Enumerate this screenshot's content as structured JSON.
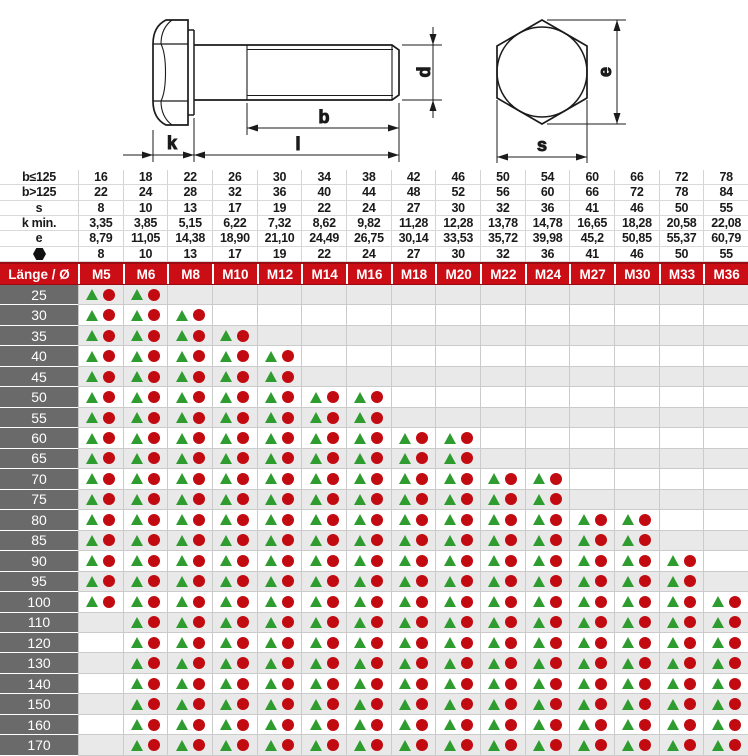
{
  "drawing": {
    "labels": {
      "k": "k",
      "b": "b",
      "l": "l",
      "d": "d",
      "e": "e",
      "s": "s"
    }
  },
  "spec_table": {
    "rows": [
      {
        "label": "b≤125",
        "values": [
          "16",
          "18",
          "22",
          "26",
          "30",
          "34",
          "38",
          "42",
          "46",
          "50",
          "54",
          "60",
          "66",
          "72",
          "78"
        ]
      },
      {
        "label": "b>125",
        "values": [
          "22",
          "24",
          "28",
          "32",
          "36",
          "40",
          "44",
          "48",
          "52",
          "56",
          "60",
          "66",
          "72",
          "78",
          "84"
        ]
      },
      {
        "label": "s",
        "values": [
          "8",
          "10",
          "13",
          "17",
          "19",
          "22",
          "24",
          "27",
          "30",
          "32",
          "36",
          "41",
          "46",
          "50",
          "55"
        ]
      },
      {
        "label": "k min.",
        "values": [
          "3,35",
          "3,85",
          "5,15",
          "6,22",
          "7,32",
          "8,62",
          "9,82",
          "11,28",
          "12,28",
          "13,78",
          "14,78",
          "16,65",
          "18,28",
          "20,58",
          "22,08"
        ]
      },
      {
        "label": "e",
        "values": [
          "8,79",
          "11,05",
          "14,38",
          "18,90",
          "21,10",
          "24,49",
          "26,75",
          "30,14",
          "33,53",
          "35,72",
          "39,98",
          "45,2",
          "50,85",
          "55,37",
          "60,79"
        ]
      },
      {
        "label": "",
        "icon": "hexagon-icon",
        "values": [
          "8",
          "10",
          "13",
          "17",
          "19",
          "22",
          "24",
          "27",
          "30",
          "32",
          "36",
          "41",
          "46",
          "50",
          "55"
        ]
      }
    ]
  },
  "matrix": {
    "corner_label": "Länge / Ø",
    "columns": [
      "M5",
      "M6",
      "M8",
      "M10",
      "M12",
      "M14",
      "M16",
      "M18",
      "M20",
      "M22",
      "M24",
      "M27",
      "M30",
      "M33",
      "M36"
    ],
    "cell_symbols": [
      "triangle",
      "circle"
    ],
    "rows": [
      {
        "length": "25",
        "from": "M5",
        "to": "M6"
      },
      {
        "length": "30",
        "from": "M5",
        "to": "M8"
      },
      {
        "length": "35",
        "from": "M5",
        "to": "M10"
      },
      {
        "length": "40",
        "from": "M5",
        "to": "M12"
      },
      {
        "length": "45",
        "from": "M5",
        "to": "M12"
      },
      {
        "length": "50",
        "from": "M5",
        "to": "M16"
      },
      {
        "length": "55",
        "from": "M5",
        "to": "M16"
      },
      {
        "length": "60",
        "from": "M5",
        "to": "M20"
      },
      {
        "length": "65",
        "from": "M5",
        "to": "M20"
      },
      {
        "length": "70",
        "from": "M5",
        "to": "M24"
      },
      {
        "length": "75",
        "from": "M5",
        "to": "M24"
      },
      {
        "length": "80",
        "from": "M5",
        "to": "M30"
      },
      {
        "length": "85",
        "from": "M5",
        "to": "M30"
      },
      {
        "length": "90",
        "from": "M5",
        "to": "M33"
      },
      {
        "length": "95",
        "from": "M5",
        "to": "M33"
      },
      {
        "length": "100",
        "from": "M5",
        "to": "M36"
      },
      {
        "length": "110",
        "from": "M6",
        "to": "M36"
      },
      {
        "length": "120",
        "from": "M6",
        "to": "M36"
      },
      {
        "length": "130",
        "from": "M6",
        "to": "M36"
      },
      {
        "length": "140",
        "from": "M6",
        "to": "M36"
      },
      {
        "length": "150",
        "from": "M6",
        "to": "M36"
      },
      {
        "length": "160",
        "from": "M6",
        "to": "M36"
      },
      {
        "length": "170",
        "from": "M6",
        "to": "M36"
      }
    ]
  },
  "colors": {
    "header_red": "#cb0e16",
    "label_gray": "#6a6a6a",
    "row_alt_gray": "#e9e9e9",
    "triangle_green": "#2f9c2f",
    "circle_red": "#c20b11"
  }
}
